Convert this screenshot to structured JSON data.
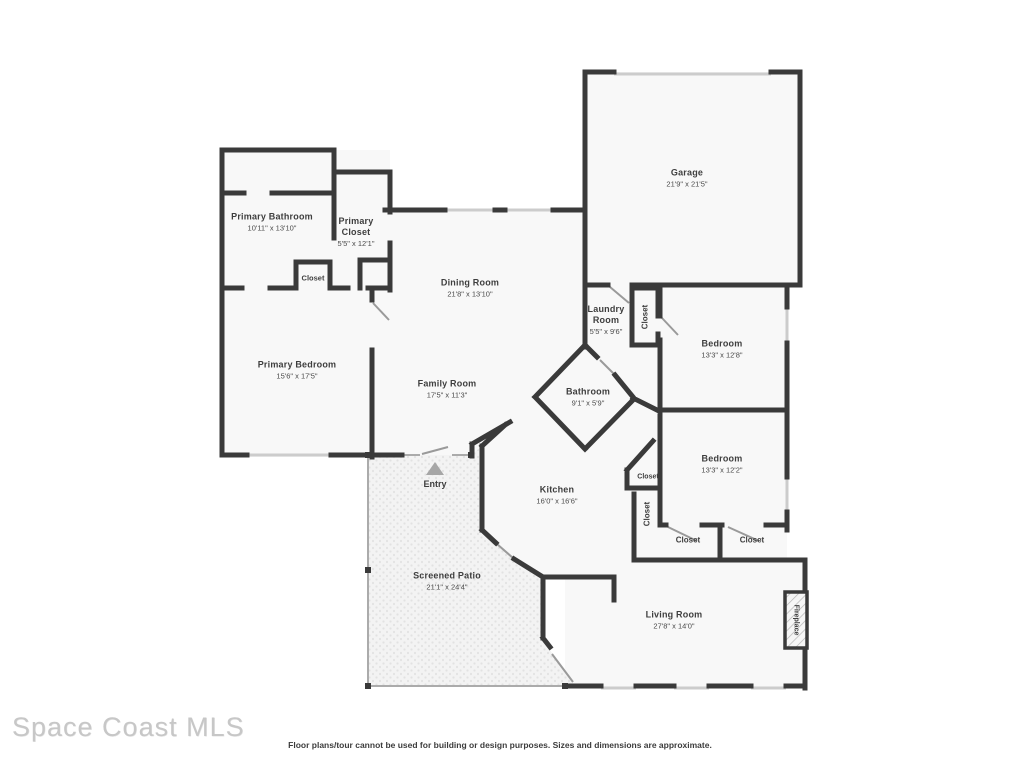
{
  "watermark": "Space Coast MLS",
  "disclaimer": "Floor plans/tour cannot be used for building or design purposes. Sizes and dimensions are approximate.",
  "colors": {
    "wall": "#3a3a3a",
    "room_fill": "#f8f8f8",
    "window": "#cccccc",
    "door": "#9a9a9a",
    "patio_dot": "#e2e2e2",
    "label": "#3e3e3e",
    "entry_arrow": "#a6a6a6",
    "watermark": "#c7c7c7"
  },
  "rooms": {
    "primary_bathroom": {
      "name": "Primary Bathroom",
      "dims": "10'11\" x 13'10\""
    },
    "primary_closet": {
      "name": "Primary Closet",
      "dims": "5'5\" x 12'1\""
    },
    "garage": {
      "name": "Garage",
      "dims": "21'9\" x 21'5\""
    },
    "dining_room": {
      "name": "Dining Room",
      "dims": "21'8\" x 13'10\""
    },
    "laundry_room": {
      "name": "Laundry Room",
      "dims": "5'5\" x 9'6\""
    },
    "bedroom_1": {
      "name": "Bedroom",
      "dims": "13'3\" x 12'8\""
    },
    "primary_bedroom": {
      "name": "Primary Bedroom",
      "dims": "15'6\" x 17'5\""
    },
    "family_room": {
      "name": "Family Room",
      "dims": "17'5\" x 11'3\""
    },
    "bathroom": {
      "name": "Bathroom",
      "dims": "9'1\" x 5'9\""
    },
    "kitchen": {
      "name": "Kitchen",
      "dims": "16'0\" x 16'6\""
    },
    "bedroom_2": {
      "name": "Bedroom",
      "dims": "13'3\" x 12'2\""
    },
    "screened_patio": {
      "name": "Screened Patio",
      "dims": "21'1\" x 24'4\""
    },
    "living_room": {
      "name": "Living Room",
      "dims": "27'8\" x 14'0\""
    },
    "entry": {
      "name": "Entry"
    },
    "fireplace": {
      "name": "Fireplace"
    }
  },
  "closets": [
    {
      "label": "Closet"
    },
    {
      "label": "Closet"
    },
    {
      "label": "Closet"
    },
    {
      "label": "Closet"
    },
    {
      "label": "Closet"
    },
    {
      "label": "Closet"
    }
  ]
}
